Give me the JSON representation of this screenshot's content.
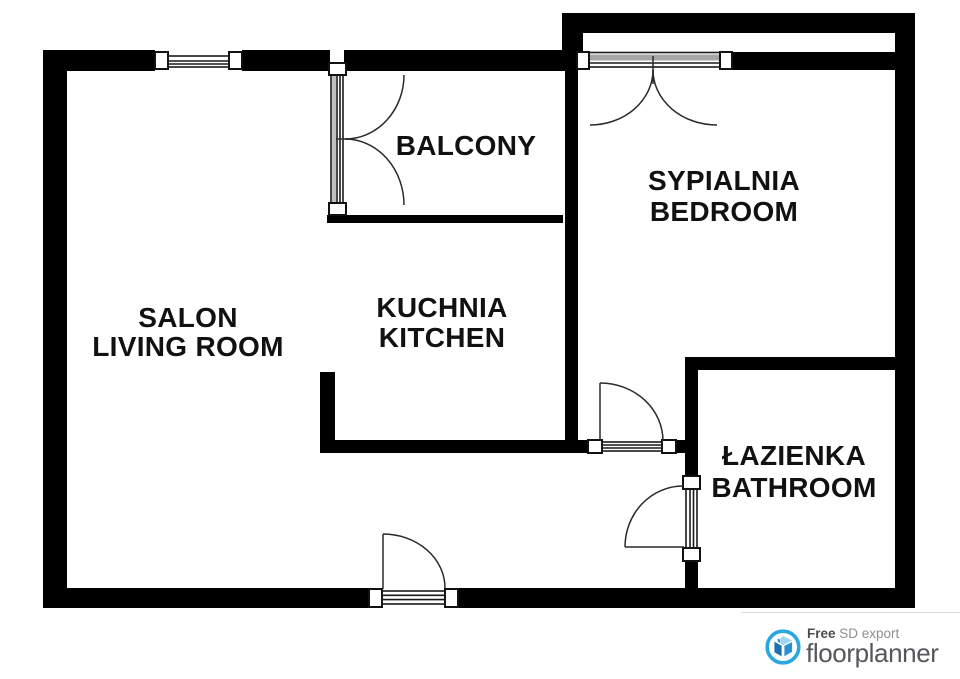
{
  "rooms": {
    "living": {
      "label_pl": "SALON",
      "label_en": "LIVING ROOM"
    },
    "kitchen": {
      "label_pl": "KUCHNIA",
      "label_en": "KITCHEN"
    },
    "balcony": {
      "label_en": "BALCONY"
    },
    "bedroom": {
      "label_pl": "SYPIALNIA",
      "label_en": "BEDROOM"
    },
    "bathroom": {
      "label_pl": "ŁAZIENKA",
      "label_en": "BATHROOM"
    }
  },
  "branding": {
    "free_label": "Free",
    "tagline": " SD export",
    "brand_name": "floorplanner",
    "icon": "floorplanner-house-icon",
    "accent_color": "#2aa7e0",
    "icon_blue_dark": "#1c6fb0",
    "icon_blue_mid": "#2b8fd0",
    "icon_blue_light": "#9fd5f2",
    "brand_text_color": "#54565a",
    "tagline_color": "#8d8f93"
  },
  "plan_style": {
    "wall_color": "#000000",
    "line_color": "#1a1a1a",
    "label_color": "#111111",
    "background": "#ffffff"
  }
}
